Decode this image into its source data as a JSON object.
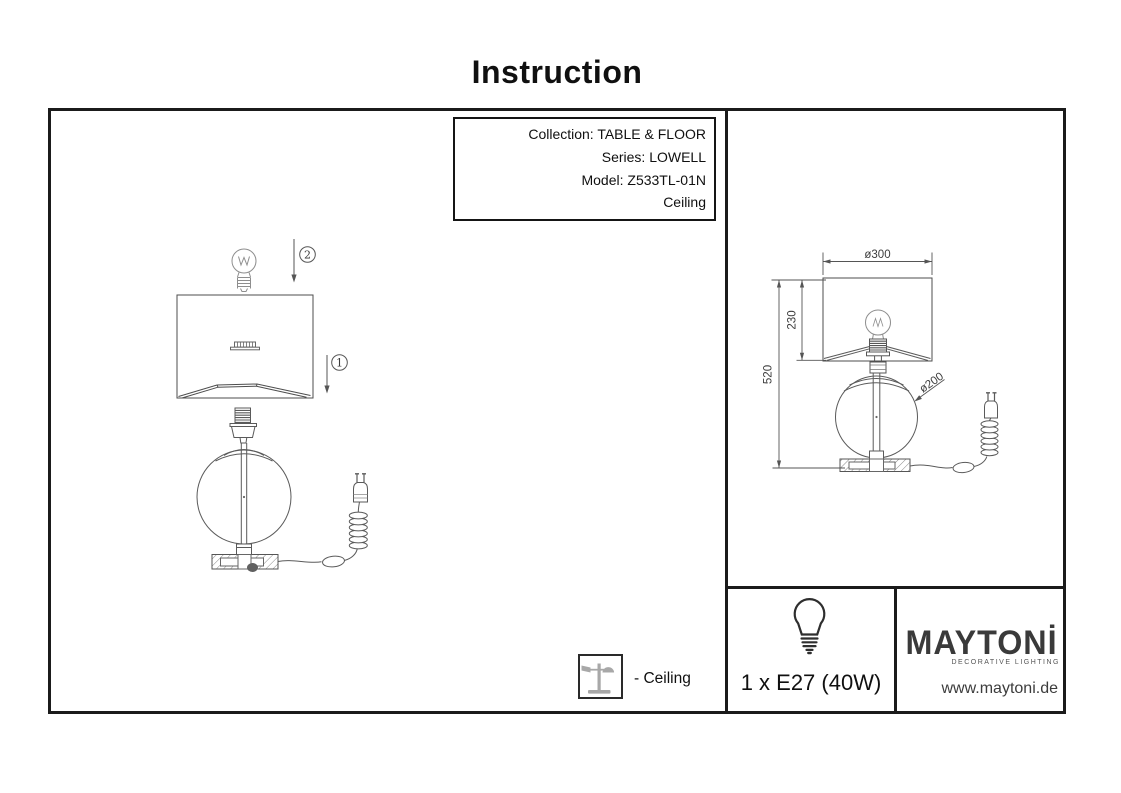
{
  "title": "Instruction",
  "product_info": {
    "collection": "Collection: TABLE & FLOOR",
    "series": "Series: LOWELL",
    "model": "Model: Z533TL-01N",
    "mount_type": "Ceiling"
  },
  "assembly": {
    "step_1": "1",
    "step_2": "2"
  },
  "dimensions": {
    "shade_diameter": "ø300",
    "shade_height": "230",
    "total_height": "520",
    "sphere_diameter": "ø200"
  },
  "legend": {
    "ceiling": "- Ceiling"
  },
  "footer": {
    "bulb_spec": "1 x E27 (40W)",
    "brand": "MAYTONİ",
    "tagline": "DECORATIVE LIGHTING",
    "website": "www.maytoni.de"
  },
  "colors": {
    "frame": "#1b1b1b",
    "drawing_line": "#555555",
    "brand_text": "#3a3a3a",
    "legend_icon_gray": "#a8a8a8"
  }
}
